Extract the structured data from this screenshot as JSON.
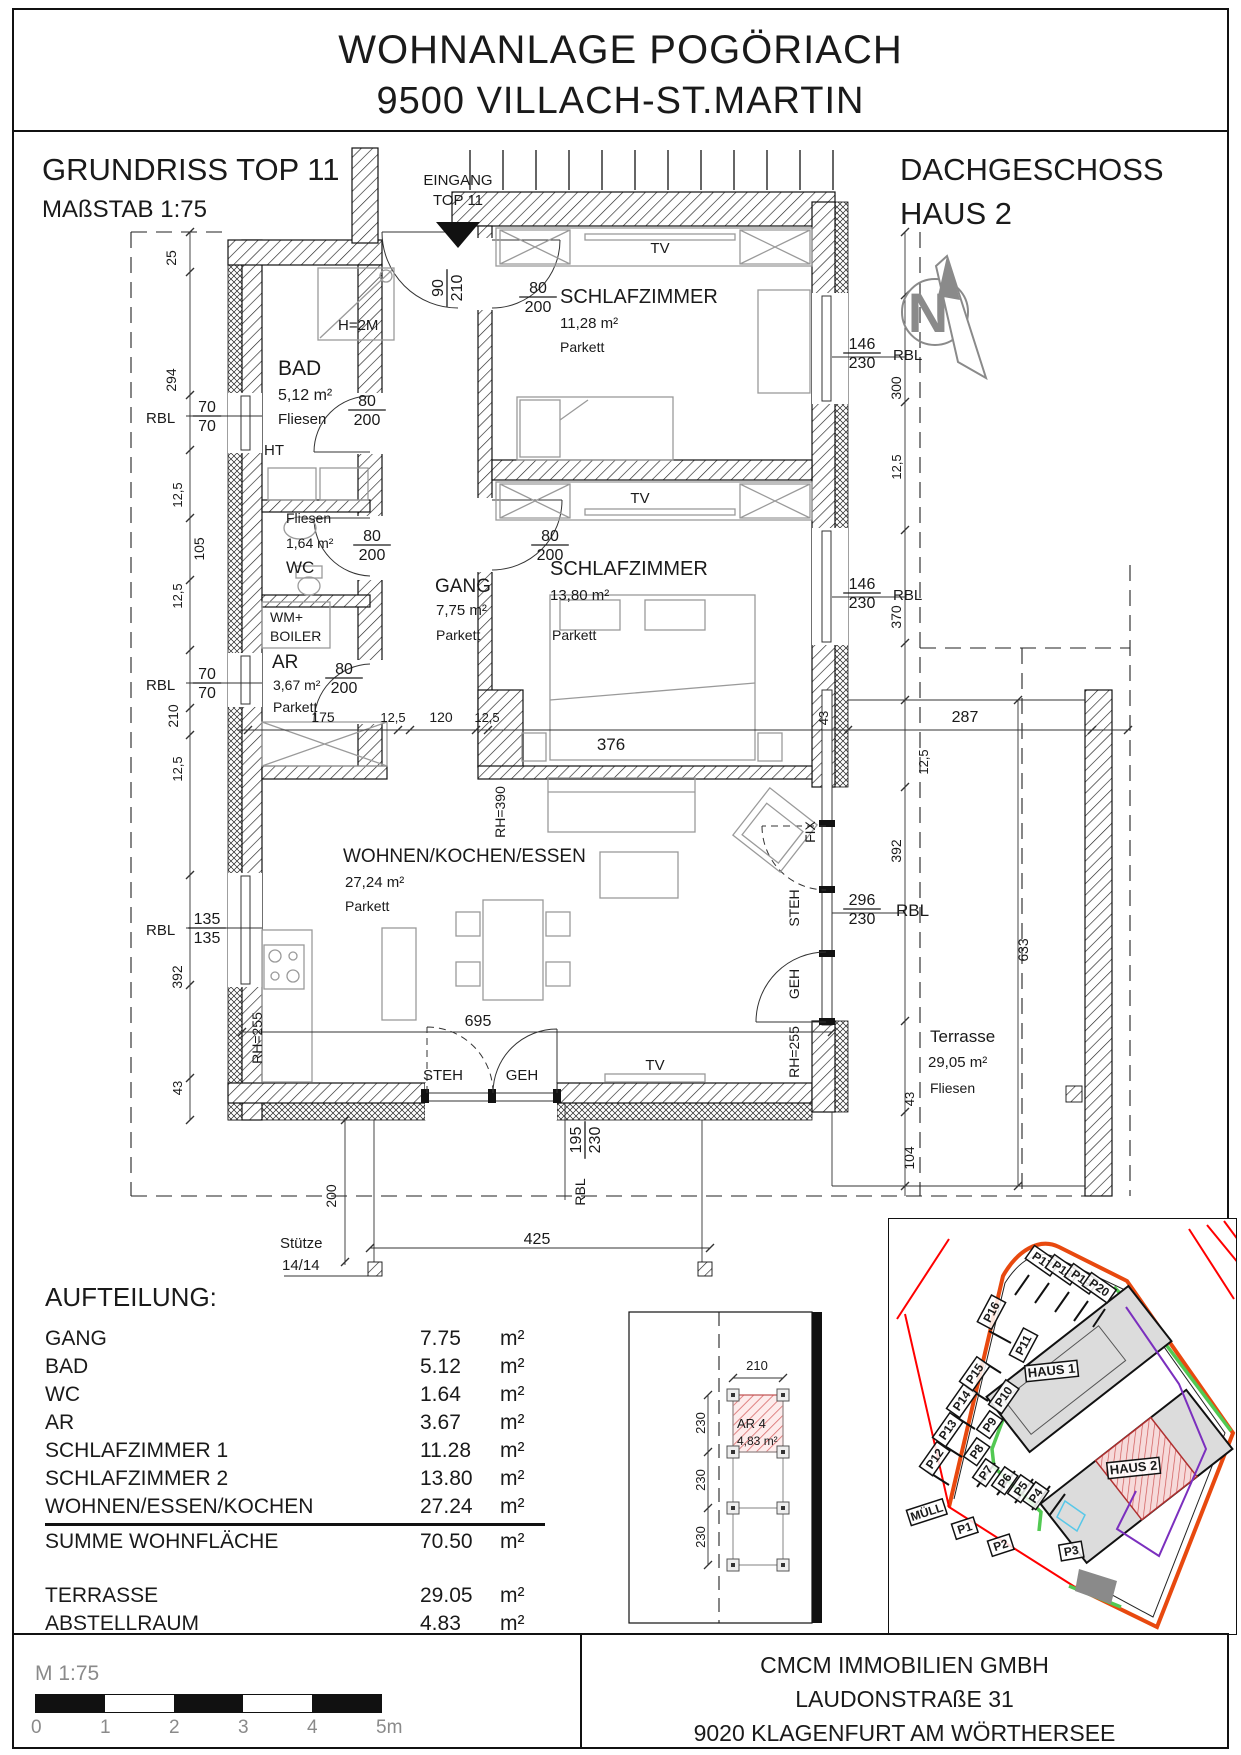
{
  "title": {
    "line1": "WOHNANLAGE POGÖRIACH",
    "line2": "9500 VILLACH-ST.MARTIN"
  },
  "header": {
    "left_title": "GRUNDRISS TOP 11",
    "left_sub": "MAßSTAB 1:75",
    "right_title": "DACHGESCHOSS",
    "right_sub": "HAUS 2"
  },
  "colors": {
    "ink": "#1a1a1a",
    "furniture_gray": "#9a9a9a",
    "dim_gray": "#8a8a8a",
    "unit_red_hatch": "#d96a6a",
    "site_orange": "#e8490f",
    "site_red": "#ff0000",
    "site_green": "#52c952",
    "site_purple": "#7b2fbe",
    "site_cyan": "#58c8e8",
    "building_gray": "#dcdcdc"
  },
  "plan": {
    "labels": [
      {
        "t": "EINGANG",
        "x": 458,
        "y": 185,
        "s": 15,
        "a": "m",
        "n": "entrance-label"
      },
      {
        "t": "TOP 11",
        "x": 458,
        "y": 205,
        "s": 15,
        "a": "m",
        "n": "entrance-label"
      },
      {
        "t": "N",
        "x": 928,
        "y": 332,
        "s": 56,
        "a": "m",
        "c": "#8a8a8a",
        "w": "bold",
        "n": "north-letter"
      },
      {
        "t": "BAD",
        "x": 278,
        "y": 375,
        "s": 21,
        "n": "room-name"
      },
      {
        "t": "5,12 m²",
        "x": 278,
        "y": 400,
        "s": 16,
        "n": "room-area"
      },
      {
        "t": "Fliesen",
        "x": 278,
        "y": 424,
        "s": 15,
        "n": "room-floor"
      },
      {
        "t": "HT",
        "x": 264,
        "y": 455,
        "s": 15,
        "n": "note"
      },
      {
        "t": "H=2M",
        "x": 338,
        "y": 330,
        "s": 15,
        "n": "note"
      },
      {
        "t": "Fliesen",
        "x": 286,
        "y": 523,
        "s": 14,
        "n": "room-floor"
      },
      {
        "t": "1,64 m²",
        "x": 286,
        "y": 548,
        "s": 14,
        "n": "room-area"
      },
      {
        "t": "WC",
        "x": 286,
        "y": 573,
        "s": 17,
        "n": "room-name"
      },
      {
        "t": "WM+",
        "x": 270,
        "y": 622,
        "s": 14,
        "n": "note"
      },
      {
        "t": "BOILER",
        "x": 270,
        "y": 641,
        "s": 14,
        "n": "note"
      },
      {
        "t": "AR",
        "x": 272,
        "y": 668,
        "s": 19,
        "n": "room-name"
      },
      {
        "t": "3,67 m²",
        "x": 273,
        "y": 690,
        "s": 14,
        "n": "room-area"
      },
      {
        "t": "Parkett",
        "x": 273,
        "y": 712,
        "s": 14,
        "n": "room-floor"
      },
      {
        "t": "GANG",
        "x": 435,
        "y": 592,
        "s": 19,
        "n": "room-name"
      },
      {
        "t": "7,75 m²",
        "x": 436,
        "y": 615,
        "s": 15,
        "n": "room-area"
      },
      {
        "t": "Parkett",
        "x": 436,
        "y": 640,
        "s": 14,
        "n": "room-floor"
      },
      {
        "t": "SCHLAFZIMMER",
        "x": 560,
        "y": 303,
        "s": 20,
        "n": "room-name"
      },
      {
        "t": "11,28 m²",
        "x": 560,
        "y": 328,
        "s": 15,
        "n": "room-area"
      },
      {
        "t": "Parkett",
        "x": 560,
        "y": 352,
        "s": 14,
        "n": "room-floor"
      },
      {
        "t": "SCHLAFZIMMER",
        "x": 550,
        "y": 575,
        "s": 20,
        "n": "room-name"
      },
      {
        "t": "13,80 m²",
        "x": 550,
        "y": 600,
        "s": 15,
        "n": "room-area"
      },
      {
        "t": "Parkett",
        "x": 552,
        "y": 640,
        "s": 14,
        "n": "room-floor"
      },
      {
        "t": "WOHNEN/KOCHEN/ESSEN",
        "x": 343,
        "y": 862,
        "s": 19,
        "n": "room-name"
      },
      {
        "t": "27,24 m²",
        "x": 345,
        "y": 887,
        "s": 15,
        "n": "room-area"
      },
      {
        "t": "Parkett",
        "x": 345,
        "y": 911,
        "s": 14,
        "n": "room-floor"
      },
      {
        "t": "Terrasse",
        "x": 930,
        "y": 1042,
        "s": 17,
        "n": "room-name"
      },
      {
        "t": "29,05 m²",
        "x": 928,
        "y": 1067,
        "s": 15,
        "n": "room-area"
      },
      {
        "t": "Fliesen",
        "x": 930,
        "y": 1093,
        "s": 14,
        "n": "room-floor"
      },
      {
        "t": "TV",
        "x": 660,
        "y": 253,
        "s": 15,
        "a": "m",
        "n": "tv-label"
      },
      {
        "t": "TV",
        "x": 640,
        "y": 503,
        "s": 15,
        "a": "m",
        "n": "tv-label"
      },
      {
        "t": "TV",
        "x": 655,
        "y": 1070,
        "s": 15,
        "a": "m",
        "n": "tv-label"
      },
      {
        "t": "STEH",
        "x": 443,
        "y": 1080,
        "s": 15,
        "a": "m",
        "n": "door-label"
      },
      {
        "t": "GEH",
        "x": 522,
        "y": 1080,
        "s": 15,
        "a": "m",
        "n": "door-label"
      },
      {
        "t": "175",
        "x": 323,
        "y": 722,
        "s": 14,
        "a": "m",
        "n": "dim"
      },
      {
        "t": "12,5",
        "x": 393,
        "y": 722,
        "s": 13,
        "a": "m",
        "n": "dim"
      },
      {
        "t": "120",
        "x": 441,
        "y": 722,
        "s": 14,
        "a": "m",
        "n": "dim"
      },
      {
        "t": "12,5",
        "x": 487,
        "y": 722,
        "s": 13,
        "a": "m",
        "n": "dim"
      },
      {
        "t": "376",
        "x": 611,
        "y": 750,
        "s": 17,
        "a": "m",
        "n": "dim"
      },
      {
        "t": "287",
        "x": 965,
        "y": 722,
        "s": 16,
        "a": "m",
        "n": "dim"
      },
      {
        "t": "695",
        "x": 478,
        "y": 1026,
        "s": 16,
        "a": "m",
        "n": "dim"
      },
      {
        "t": "425",
        "x": 537,
        "y": 1244,
        "s": 16,
        "a": "m",
        "n": "dim"
      },
      {
        "t": "Stütze",
        "x": 280,
        "y": 1248,
        "s": 15,
        "n": "note"
      },
      {
        "t": "14/14",
        "x": 282,
        "y": 1270,
        "s": 15,
        "n": "note"
      },
      {
        "t": "RBL",
        "x": 146,
        "y": 423,
        "s": 15,
        "n": "rbl-label"
      },
      {
        "t": "RBL",
        "x": 146,
        "y": 690,
        "s": 15,
        "n": "rbl-label"
      },
      {
        "t": "RBL",
        "x": 146,
        "y": 935,
        "s": 15,
        "n": "rbl-label"
      },
      {
        "t": "RBL",
        "x": 893,
        "y": 360,
        "s": 15,
        "n": "rbl-label"
      },
      {
        "t": "RBL",
        "x": 893,
        "y": 600,
        "s": 15,
        "n": "rbl-label"
      },
      {
        "t": "RBL",
        "x": 896,
        "y": 916,
        "s": 17,
        "n": "rbl-label"
      },
      {
        "t": "25",
        "x": 176,
        "y": 258,
        "s": 14,
        "r": -90,
        "a": "m",
        "n": "dim"
      },
      {
        "t": "294",
        "x": 176,
        "y": 380,
        "s": 14,
        "r": -90,
        "a": "m",
        "n": "dim"
      },
      {
        "t": "12,5",
        "x": 182,
        "y": 495,
        "s": 13,
        "r": -90,
        "a": "m",
        "n": "dim"
      },
      {
        "t": "105",
        "x": 204,
        "y": 549,
        "s": 14,
        "r": -90,
        "a": "m",
        "n": "dim"
      },
      {
        "t": "12,5",
        "x": 182,
        "y": 596,
        "s": 13,
        "r": -90,
        "a": "m",
        "n": "dim"
      },
      {
        "t": "210",
        "x": 178,
        "y": 716,
        "s": 14,
        "r": -90,
        "a": "m",
        "n": "dim"
      },
      {
        "t": "12,5",
        "x": 182,
        "y": 769,
        "s": 13,
        "r": -90,
        "a": "m",
        "n": "dim"
      },
      {
        "t": "392",
        "x": 182,
        "y": 977,
        "s": 14,
        "r": -90,
        "a": "m",
        "n": "dim"
      },
      {
        "t": "43",
        "x": 182,
        "y": 1088,
        "s": 13,
        "r": -90,
        "a": "m",
        "n": "dim"
      },
      {
        "t": "300",
        "x": 901,
        "y": 388,
        "s": 14,
        "r": -90,
        "a": "m",
        "n": "dim"
      },
      {
        "t": "12,5",
        "x": 901,
        "y": 467,
        "s": 13,
        "r": -90,
        "a": "m",
        "n": "dim"
      },
      {
        "t": "370",
        "x": 901,
        "y": 617,
        "s": 14,
        "r": -90,
        "a": "m",
        "n": "dim"
      },
      {
        "t": "43",
        "x": 828,
        "y": 718,
        "s": 13,
        "r": -90,
        "a": "m",
        "n": "dim"
      },
      {
        "t": "12,5",
        "x": 928,
        "y": 762,
        "s": 13,
        "r": -90,
        "a": "m",
        "n": "dim"
      },
      {
        "t": "392",
        "x": 901,
        "y": 851,
        "s": 14,
        "r": -90,
        "a": "m",
        "n": "dim"
      },
      {
        "t": "633",
        "x": 1028,
        "y": 950,
        "s": 14,
        "r": -90,
        "a": "m",
        "n": "dim"
      },
      {
        "t": "43",
        "x": 914,
        "y": 1099,
        "s": 13,
        "r": -90,
        "a": "m",
        "n": "dim"
      },
      {
        "t": "104",
        "x": 914,
        "y": 1158,
        "s": 14,
        "r": -90,
        "a": "m",
        "n": "dim"
      },
      {
        "t": "200",
        "x": 336,
        "y": 1196,
        "s": 14,
        "r": -90,
        "a": "m",
        "n": "dim"
      },
      {
        "t": "RH=390",
        "x": 505,
        "y": 812,
        "s": 14,
        "r": -90,
        "a": "m",
        "n": "height-note"
      },
      {
        "t": "RH=255",
        "x": 262,
        "y": 1038,
        "s": 14,
        "r": -90,
        "a": "m",
        "n": "height-note"
      },
      {
        "t": "FIX",
        "x": 815,
        "y": 832,
        "s": 14,
        "r": -90,
        "a": "m",
        "n": "window-note"
      },
      {
        "t": "STEH",
        "x": 799,
        "y": 908,
        "s": 14,
        "r": -90,
        "a": "m",
        "n": "door-label"
      },
      {
        "t": "GEH",
        "x": 799,
        "y": 984,
        "s": 14,
        "r": -90,
        "a": "m",
        "n": "door-label"
      },
      {
        "t": "RH=255",
        "x": 799,
        "y": 1052,
        "s": 14,
        "r": -90,
        "a": "m",
        "n": "height-note"
      },
      {
        "t": "RBL",
        "x": 585,
        "y": 1192,
        "s": 14,
        "r": -90,
        "a": "m",
        "n": "rbl-label"
      }
    ],
    "fracs": [
      {
        "t1": "90",
        "t2": "210",
        "x": 447,
        "y": 288,
        "r": -90
      },
      {
        "t1": "80",
        "t2": "200",
        "x": 367,
        "y": 410
      },
      {
        "t1": "80",
        "t2": "200",
        "x": 372,
        "y": 545
      },
      {
        "t1": "80",
        "t2": "200",
        "x": 344,
        "y": 678
      },
      {
        "t1": "80",
        "t2": "200",
        "x": 538,
        "y": 297
      },
      {
        "t1": "80",
        "t2": "200",
        "x": 550,
        "y": 545
      },
      {
        "t1": "70",
        "t2": "70",
        "x": 207,
        "y": 416
      },
      {
        "t1": "70",
        "t2": "70",
        "x": 207,
        "y": 683
      },
      {
        "t1": "135",
        "t2": "135",
        "x": 207,
        "y": 928
      },
      {
        "t1": "146",
        "t2": "230",
        "x": 862,
        "y": 353
      },
      {
        "t1": "146",
        "t2": "230",
        "x": 862,
        "y": 593
      },
      {
        "t1": "296",
        "t2": "230",
        "x": 862,
        "y": 909
      },
      {
        "t1": "195",
        "t2": "230",
        "x": 585,
        "y": 1140,
        "r": -90
      }
    ]
  },
  "storage_plan": {
    "labels": [
      {
        "t": "AR 4",
        "x": 737,
        "y": 1428,
        "s": 13,
        "n": "room-name"
      },
      {
        "t": "4,83 m²",
        "x": 737,
        "y": 1445,
        "s": 12,
        "n": "room-area"
      },
      {
        "t": "210",
        "x": 757,
        "y": 1370,
        "s": 13,
        "a": "m",
        "n": "dim"
      },
      {
        "t": "230",
        "x": 705,
        "y": 1423,
        "s": 13,
        "r": -90,
        "a": "m",
        "n": "dim"
      },
      {
        "t": "230",
        "x": 705,
        "y": 1480,
        "s": 13,
        "r": -90,
        "a": "m",
        "n": "dim"
      },
      {
        "t": "230",
        "x": 705,
        "y": 1537,
        "s": 13,
        "r": -90,
        "a": "m",
        "n": "dim"
      }
    ]
  },
  "site_plan": {
    "labels": [
      {
        "t": "HAUS 1",
        "x": 163,
        "y": 156,
        "s": 13,
        "a": "m",
        "w": "bold",
        "box": true,
        "r": -6,
        "n": "building-label"
      },
      {
        "t": "HAUS 2",
        "x": 245,
        "y": 253,
        "s": 13,
        "a": "m",
        "w": "bold",
        "box": true,
        "r": -6,
        "n": "building-label"
      },
      {
        "t": "P12",
        "x": 49,
        "y": 242,
        "s": 12,
        "a": "m",
        "w": "bold",
        "box": true,
        "r": -55,
        "n": "parking-label"
      },
      {
        "t": "P13",
        "x": 62,
        "y": 213,
        "s": 12,
        "a": "m",
        "w": "bold",
        "box": true,
        "r": -55,
        "n": "parking-label"
      },
      {
        "t": "P14",
        "x": 76,
        "y": 184,
        "s": 12,
        "a": "m",
        "w": "bold",
        "box": true,
        "r": -55,
        "n": "parking-label"
      },
      {
        "t": "P15",
        "x": 89,
        "y": 157,
        "s": 12,
        "a": "m",
        "w": "bold",
        "box": true,
        "r": -55,
        "n": "parking-label"
      },
      {
        "t": "P16",
        "x": 106,
        "y": 95,
        "s": 12,
        "a": "m",
        "w": "bold",
        "box": true,
        "r": -62,
        "n": "parking-label"
      },
      {
        "t": "P17",
        "x": 151,
        "y": 45,
        "s": 12,
        "a": "m",
        "w": "bold",
        "box": true,
        "r": 35,
        "n": "parking-label"
      },
      {
        "t": "P18",
        "x": 171,
        "y": 54,
        "s": 12,
        "a": "m",
        "w": "bold",
        "box": true,
        "r": 35,
        "n": "parking-label"
      },
      {
        "t": "P19",
        "x": 190,
        "y": 63,
        "s": 12,
        "a": "m",
        "w": "bold",
        "box": true,
        "r": 35,
        "n": "parking-label"
      },
      {
        "t": "P20",
        "x": 208,
        "y": 72,
        "s": 12,
        "a": "m",
        "w": "bold",
        "box": true,
        "r": 35,
        "n": "parking-label"
      },
      {
        "t": "P11",
        "x": 138,
        "y": 128,
        "s": 12,
        "a": "m",
        "w": "bold",
        "box": true,
        "r": -62,
        "n": "parking-label"
      },
      {
        "t": "P10",
        "x": 118,
        "y": 180,
        "s": 12,
        "a": "m",
        "w": "bold",
        "box": true,
        "r": -55,
        "n": "parking-label"
      },
      {
        "t": "P9",
        "x": 104,
        "y": 208,
        "s": 12,
        "a": "m",
        "w": "bold",
        "box": true,
        "r": -55,
        "n": "parking-label"
      },
      {
        "t": "P8",
        "x": 91,
        "y": 235,
        "s": 12,
        "a": "m",
        "w": "bold",
        "box": true,
        "r": -55,
        "n": "parking-label"
      },
      {
        "t": "P7",
        "x": 100,
        "y": 256,
        "s": 12,
        "a": "m",
        "w": "bold",
        "box": true,
        "r": -55,
        "n": "parking-label"
      },
      {
        "t": "P6",
        "x": 119,
        "y": 264,
        "s": 12,
        "a": "m",
        "w": "bold",
        "box": true,
        "r": -55,
        "n": "parking-label"
      },
      {
        "t": "P5",
        "x": 135,
        "y": 272,
        "s": 12,
        "a": "m",
        "w": "bold",
        "box": true,
        "r": -55,
        "n": "parking-label"
      },
      {
        "t": "P4",
        "x": 150,
        "y": 279,
        "s": 12,
        "a": "m",
        "w": "bold",
        "box": true,
        "r": -55,
        "n": "parking-label"
      },
      {
        "t": "MÜLL",
        "x": 39,
        "y": 297,
        "s": 12,
        "a": "m",
        "w": "bold",
        "box": true,
        "r": -18,
        "n": "waste-label"
      },
      {
        "t": "P1",
        "x": 77,
        "y": 313,
        "s": 12,
        "a": "m",
        "w": "bold",
        "box": true,
        "r": -18,
        "n": "parking-label"
      },
      {
        "t": "P2",
        "x": 113,
        "y": 330,
        "s": 12,
        "a": "m",
        "w": "bold",
        "box": true,
        "r": -18,
        "n": "parking-label"
      },
      {
        "t": "P3",
        "x": 183,
        "y": 336,
        "s": 12,
        "a": "m",
        "w": "bold",
        "box": true,
        "r": -10,
        "n": "parking-label"
      }
    ]
  },
  "aufteilung": {
    "title": "AUFTEILUNG:",
    "unit": "m²",
    "rows": [
      {
        "label": "GANG",
        "value": "7.75"
      },
      {
        "label": "BAD",
        "value": "5.12"
      },
      {
        "label": "WC",
        "value": "1.64"
      },
      {
        "label": "AR",
        "value": "3.67"
      },
      {
        "label": "SCHLAFZIMMER 1",
        "value": "11.28"
      },
      {
        "label": "SCHLAFZIMMER 2",
        "value": "13.80"
      },
      {
        "label": "WOHNEN/ESSEN/KOCHEN",
        "value": "27.24"
      }
    ],
    "sum_row": {
      "label": "SUMME WOHNFLÄCHE",
      "value": "70.50"
    },
    "extra_rows": [
      {
        "label": "TERRASSE",
        "value": "29.05"
      },
      {
        "label": "ABSTELLRAUM",
        "value": "4.83"
      }
    ]
  },
  "scale_bar": {
    "label": "M 1:75",
    "ticks": [
      "0",
      "1",
      "2",
      "3",
      "4",
      "5m"
    ]
  },
  "footer": {
    "line1": "CMCM IMMOBILIEN GMBH",
    "line2": "LAUDONSTRAßE 31",
    "line3": "9020 KLAGENFURT AM WÖRTHERSEE"
  }
}
